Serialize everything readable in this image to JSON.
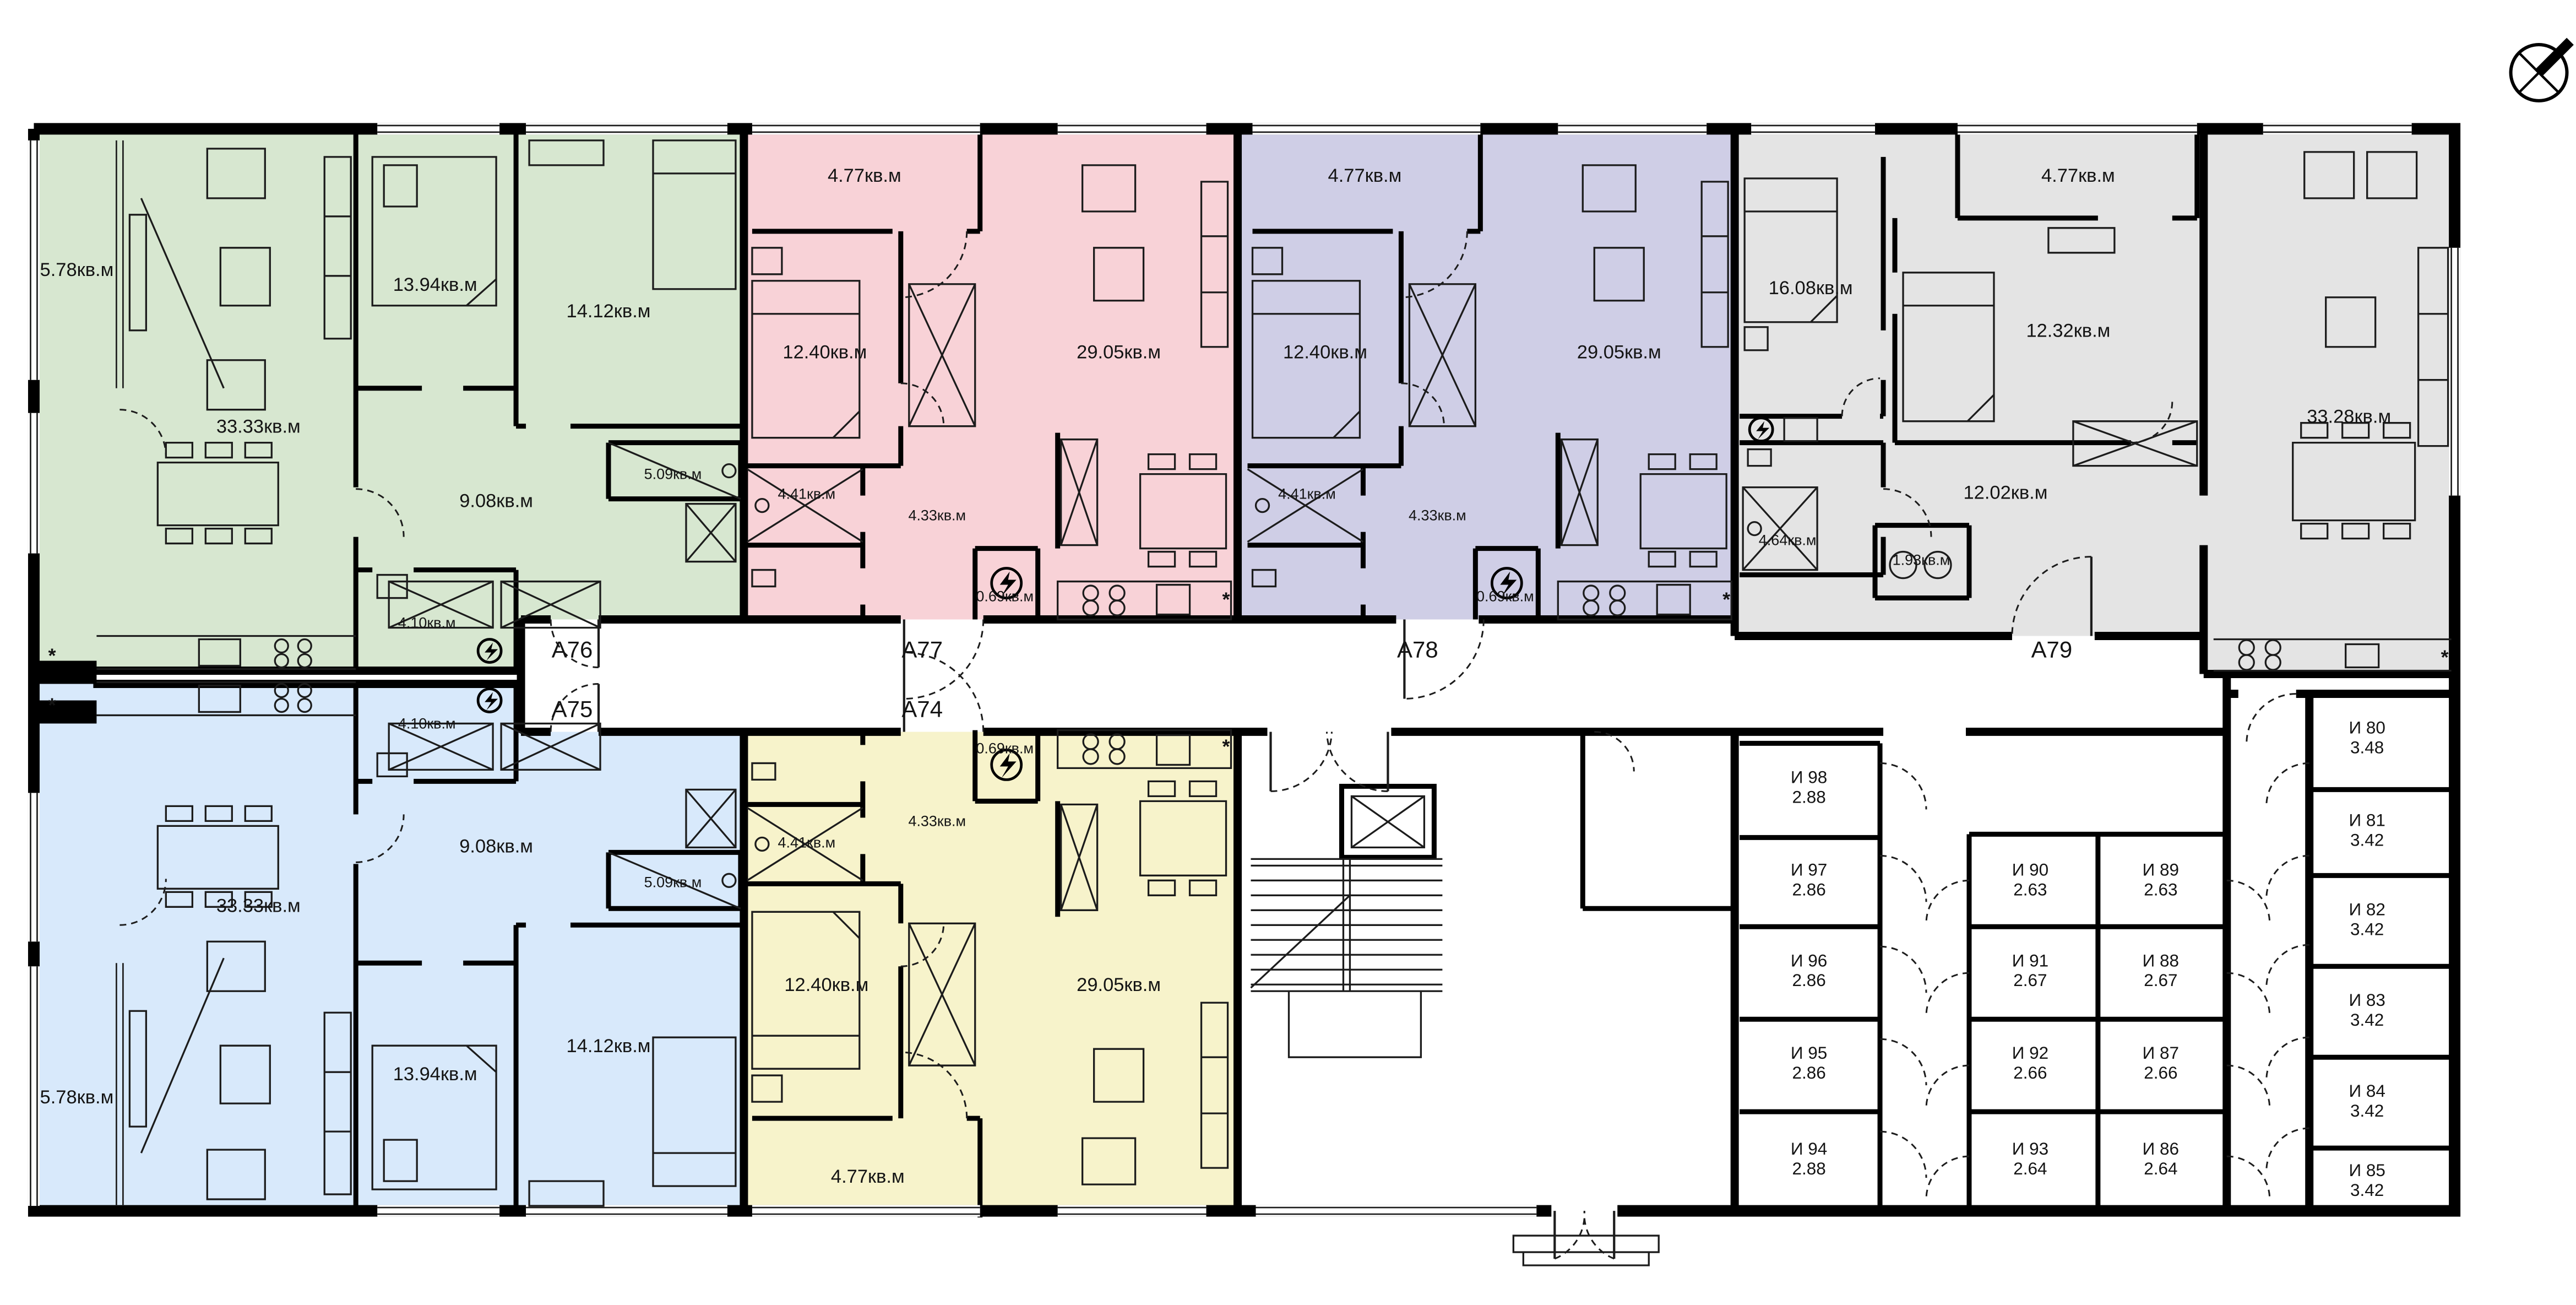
{
  "plan_type": "residential-floor-plan",
  "area_suffix": "кв.м",
  "colors": {
    "wall": "#000000",
    "background": "#ffffff",
    "a76_green": "#d7e7d0",
    "a77_pink": "#f8d2d7",
    "a78_purple": "#cfcee6",
    "a79_gray": "#e4e4e4",
    "a75_blue": "#d8e9fb",
    "a74_yellow": "#f7f3cb"
  },
  "apartments": [
    {
      "id": "A76",
      "color": "#d7e7d0",
      "rooms": {
        "balcony": "5.78кв.м",
        "living": "33.33кв.м",
        "bedroom1": "13.94кв.м",
        "bedroom2": "14.12кв.м",
        "hall": "9.08кв.м",
        "wardrobe": "5.09кв.м",
        "bathroom": "4.10кв.м"
      }
    },
    {
      "id": "A77",
      "color": "#f8d2d7",
      "rooms": {
        "balcony": "4.77кв.м",
        "bedroom": "12.40кв.м",
        "living": "29.05кв.м",
        "hall": "4.33кв.м",
        "shower": "4.41кв.м",
        "shaft": "0.69кв.м"
      }
    },
    {
      "id": "A78",
      "color": "#cfcee6",
      "rooms": {
        "balcony": "4.77кв.м",
        "bedroom": "12.40кв.м",
        "living": "29.05кв.м",
        "hall": "4.33кв.м",
        "shower": "4.41кв.м",
        "shaft": "0.69кв.м"
      }
    },
    {
      "id": "A79",
      "color": "#e4e4e4",
      "rooms": {
        "balcony": "4.77кв.м",
        "bedroom1": "16.08кв.м",
        "bedroom2": "12.32кв.м",
        "living": "33.28кв.м",
        "hall": "12.02кв.м",
        "bathroom": "4.64кв.м",
        "wc": "1.93кв.м"
      }
    },
    {
      "id": "A75",
      "color": "#d8e9fb",
      "rooms": {
        "balcony": "5.78кв.м",
        "living": "33.33кв.м",
        "bedroom1": "13.94кв.м",
        "bedroom2": "14.12кв.м",
        "hall": "9.08кв.м",
        "wardrobe": "5.09кв.м",
        "bathroom": "4.10кв.м"
      }
    },
    {
      "id": "A74",
      "color": "#f7f3cb",
      "rooms": {
        "balcony": "4.77кв.м",
        "bedroom": "12.40кв.м",
        "living": "29.05кв.м",
        "hall": "4.33кв.м",
        "shower": "4.41кв.м",
        "shaft": "0.69кв.м"
      }
    }
  ],
  "storage": {
    "left_column": [
      {
        "id": "И 98",
        "area": "2.88"
      },
      {
        "id": "И 97",
        "area": "2.86"
      },
      {
        "id": "И 96",
        "area": "2.86"
      },
      {
        "id": "И 95",
        "area": "2.86"
      },
      {
        "id": "И 94",
        "area": "2.88"
      }
    ],
    "middle_left": [
      {
        "id": "И 90",
        "area": "2.63"
      },
      {
        "id": "И 91",
        "area": "2.67"
      },
      {
        "id": "И 92",
        "area": "2.66"
      },
      {
        "id": "И 93",
        "area": "2.64"
      }
    ],
    "middle_right": [
      {
        "id": "И 89",
        "area": "2.63"
      },
      {
        "id": "И 88",
        "area": "2.67"
      },
      {
        "id": "И 87",
        "area": "2.66"
      },
      {
        "id": "И 86",
        "area": "2.64"
      }
    ],
    "right_column": [
      {
        "id": "И 80",
        "area": "3.48"
      },
      {
        "id": "И 81",
        "area": "3.42"
      },
      {
        "id": "И 82",
        "area": "3.42"
      },
      {
        "id": "И 83",
        "area": "3.42"
      },
      {
        "id": "И 84",
        "area": "3.42"
      },
      {
        "id": "И 85",
        "area": "3.42"
      }
    ]
  },
  "notes": {
    "asterisk": "*"
  }
}
